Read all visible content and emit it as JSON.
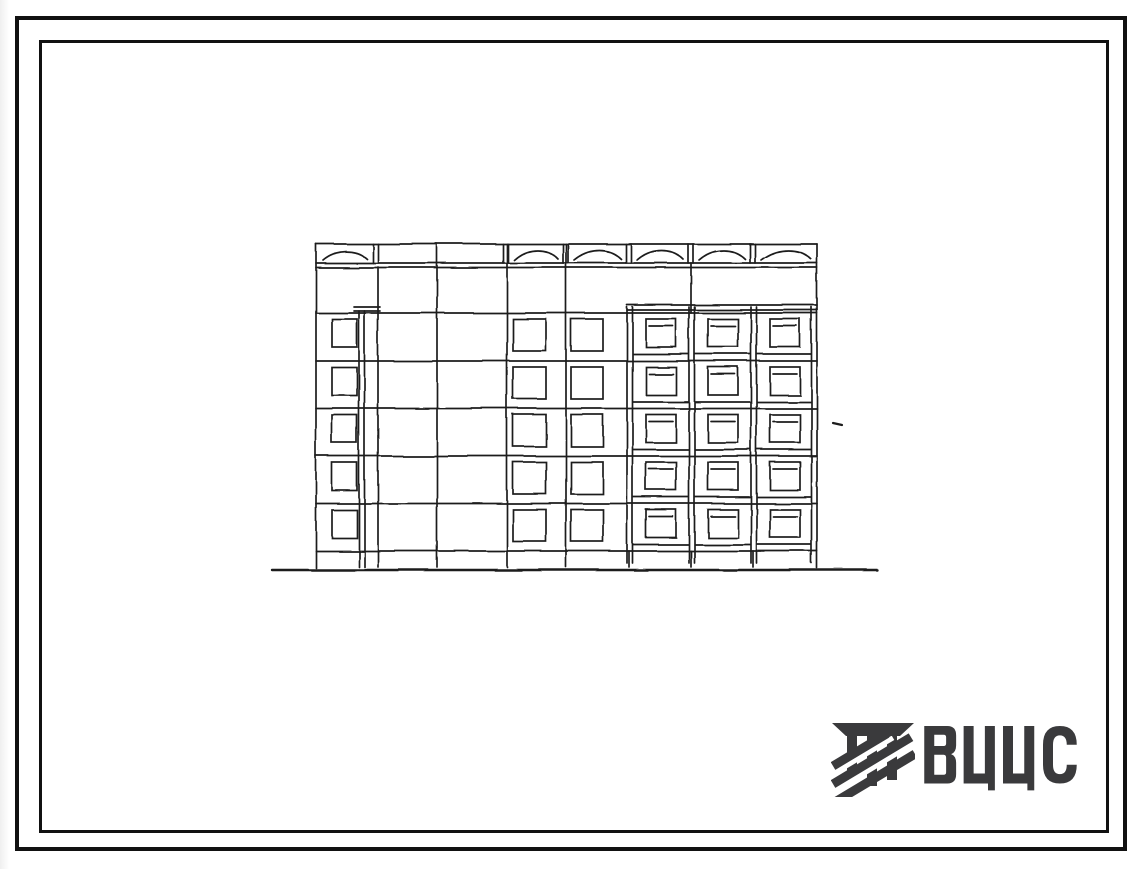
{
  "page": {
    "background_color": "#ffffff",
    "ink_color": "#1c1c1c",
    "frame_color": "#111111"
  },
  "frames": {
    "outer": {
      "left": 15,
      "top": 16,
      "width": 1112,
      "height": 835,
      "thickness": 4
    },
    "inner": {
      "left": 39,
      "top": 40,
      "width": 1070,
      "height": 793,
      "thickness": 3
    }
  },
  "elevation_drawing": {
    "kind": "hand-drawn facade elevation sketch of a five-story panel apartment building",
    "floors": 5,
    "parapet_arch_segments": 6,
    "stair_column_windows": 5,
    "plain_window_bays": 2,
    "windows_per_plain_bay": 5,
    "balcony_bays": 3,
    "balcony_cells_per_bay": 5,
    "ground_line": true
  },
  "logo": {
    "text": "ВЦИС",
    "color": "#3a3a3c",
    "icon": "stylized-column-capital-with-diagonal-hatching"
  }
}
